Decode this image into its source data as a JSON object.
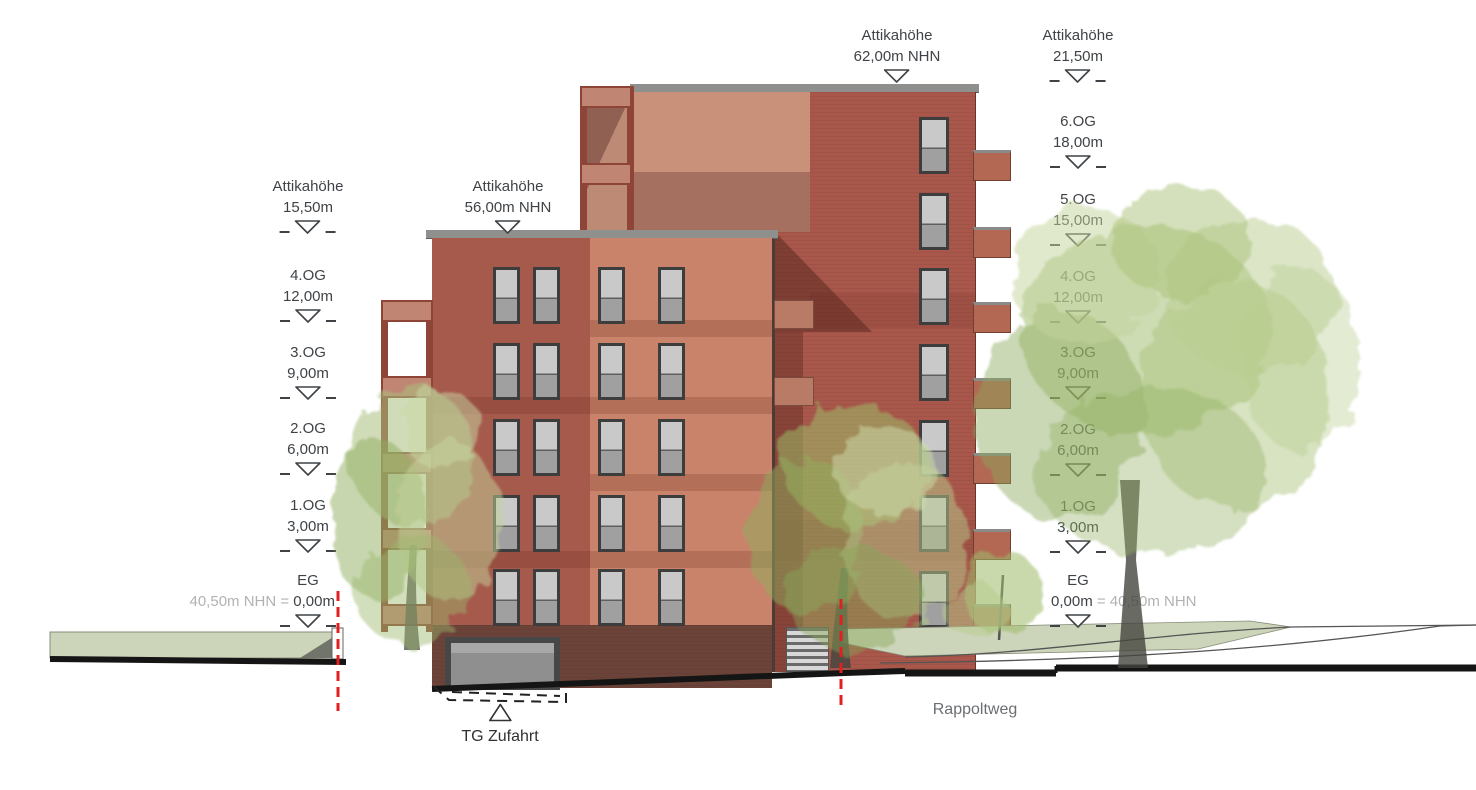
{
  "drawing": {
    "annotations": {
      "attika_rear": {
        "line1": "Attikahöhe",
        "line2": "62,00m NHN"
      },
      "attika_right": {
        "line1": "Attikahöhe",
        "line2": "21,50m"
      },
      "attika_left": {
        "line1": "Attikahöhe",
        "line2": "15,50m"
      },
      "attika_front": {
        "line1": "Attikahöhe",
        "line2": "56,00m NHN"
      },
      "left_levels": [
        {
          "name": "4.OG",
          "value": "12,00m"
        },
        {
          "name": "3.OG",
          "value": "9,00m"
        },
        {
          "name": "2.OG",
          "value": "6,00m"
        },
        {
          "name": "1.OG",
          "value": "3,00m"
        }
      ],
      "right_levels": [
        {
          "name": "6.OG",
          "value": "18,00m"
        },
        {
          "name": "5.OG",
          "value": "15,00m"
        },
        {
          "name": "4.OG",
          "value": "12,00m"
        },
        {
          "name": "3.OG",
          "value": "9,00m"
        },
        {
          "name": "2.OG",
          "value": "6,00m"
        },
        {
          "name": "1.OG",
          "value": "3,00m"
        }
      ],
      "eg_left": {
        "name": "EG",
        "gray": "40,50m NHN =",
        "value": "0,00m"
      },
      "eg_right": {
        "name": "EG",
        "value": "0,00m",
        "gray": "= 40,50m NHN"
      },
      "tg": "TG Zufahrt",
      "street": "Rappoltweg"
    },
    "colors": {
      "facade_dark_red": "#a65a4c",
      "facade_salmon": "#c9836a",
      "facade_rear": "#a8574a",
      "facade_rear_light": "#c99179",
      "plinth": "#6b4339",
      "coping_gray": "#8f8f8d",
      "balcony_panel": "#c08573",
      "balcony_frame": "#8e4538",
      "ground_green": "#ccd5ba",
      "section_line_black": "#151515",
      "marker_red": "#e02020",
      "text_dark": "#3f4347",
      "text_gray": "#b0b2b4"
    }
  }
}
